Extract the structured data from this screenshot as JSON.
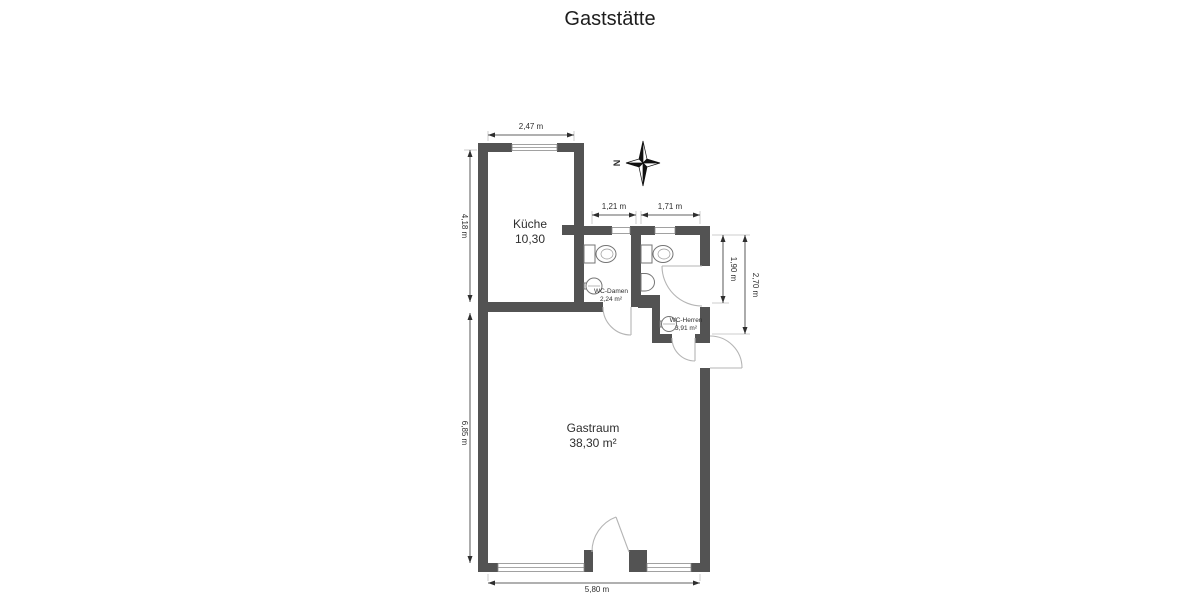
{
  "title": "Gaststätte",
  "colors": {
    "wall": "#535353",
    "door_arc": "#b5b5b5",
    "fixture_outline": "#757575",
    "dimension": "#2e2e2e",
    "background": "#ffffff"
  },
  "rooms": {
    "kueche": {
      "name": "Küche",
      "area": "10,30"
    },
    "wc_damen": {
      "name": "WC-Damen",
      "area": "2,24 m²"
    },
    "wc_herren": {
      "name": "WC-Herren",
      "area": "3,91 m²"
    },
    "gastraum": {
      "name": "Gastraum",
      "area": "38,30 m²"
    }
  },
  "dimensions": {
    "kitchen_width": "2,47 m",
    "wc_damen_width": "1,21 m",
    "wc_herren_width": "1,71 m",
    "upper_left_height": "4,18 m",
    "lower_left_height": "6,85 m",
    "wc_damen_height": "1,90 m",
    "wc_herren_height": "2,70 m",
    "bottom_width": "5,80 m"
  },
  "compass": {
    "north_label": "N"
  }
}
